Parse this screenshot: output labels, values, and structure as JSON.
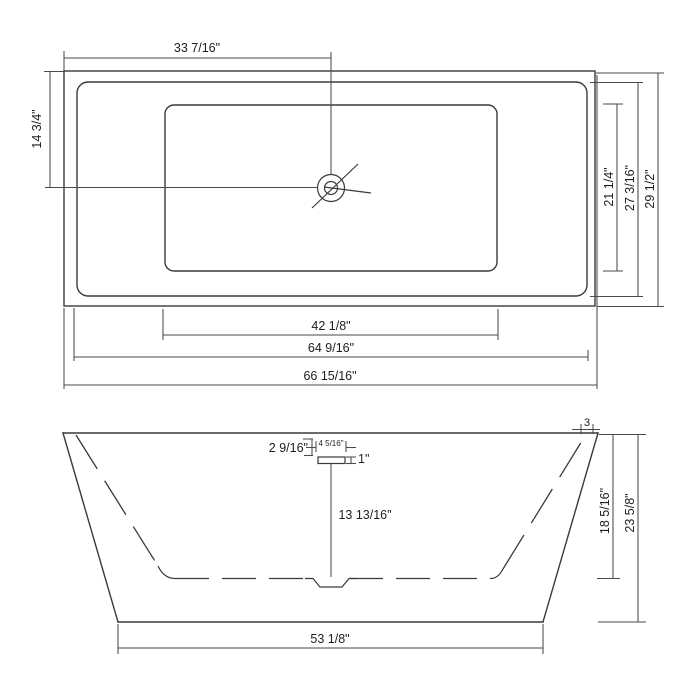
{
  "drawing": {
    "type": "bathtub-dimension-drawing",
    "top_view": {
      "dim_drain_from_left": "33 7/16\"",
      "dim_drain_from_top": "14 3/4\"",
      "dim_basin_width": "21 1/4\"",
      "dim_rim_width": "27 3/16\"",
      "dim_overall_width": "29 1/2\"",
      "dim_basin_length": "42 1/8\"",
      "dim_rim_length": "64 9/16\"",
      "dim_overall_length": "66 15/16\""
    },
    "front_view": {
      "dim_rim_to_flange": "2 9/16\"",
      "dim_flange_width": "4 5/16\"",
      "dim_flange_height": "1\"",
      "dim_drain_to_floor": "13 13/16\"",
      "dim_rim_thickness": "3",
      "dim_inner_depth": "18 5/16\"",
      "dim_overall_height": "23 5/8\"",
      "dim_base_length": "53 1/8\""
    }
  }
}
